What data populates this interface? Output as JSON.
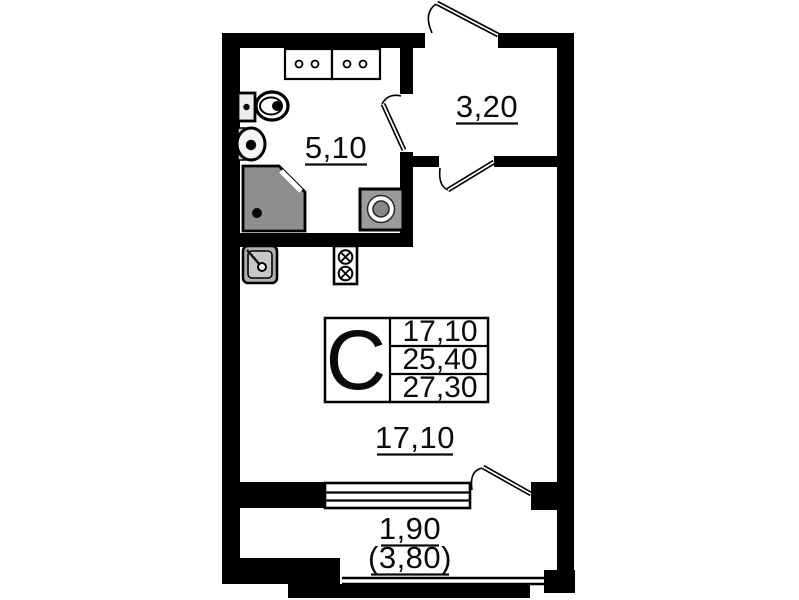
{
  "document_type": "apartment-floor-plan",
  "colors": {
    "wall": "#000000",
    "paper": "#ffffff",
    "shower_fill": "#8e8e8e",
    "appliance_fill": "#9c9c9c",
    "sink_fill": "#b0b0b0"
  },
  "rooms": {
    "bathroom": {
      "area_label": "5,10"
    },
    "hallway": {
      "area_label": "3,20"
    },
    "living_room": {
      "area_label": "17,10"
    },
    "balcony": {
      "area_label_reduced": "1,90",
      "area_label_total": "(3,80)"
    }
  },
  "info_table": {
    "type_letter": "С",
    "rows": [
      {
        "value": "17,10"
      },
      {
        "value": "25,40"
      },
      {
        "value": "27,30"
      }
    ]
  },
  "fixtures": [
    "vanity-cabinets",
    "toilet",
    "wash-basin",
    "shower-cabin",
    "washing-machine",
    "kitchen-sink",
    "stove",
    "entry-door",
    "bathroom-door",
    "room-door",
    "balcony-door",
    "window",
    "balcony-window"
  ]
}
